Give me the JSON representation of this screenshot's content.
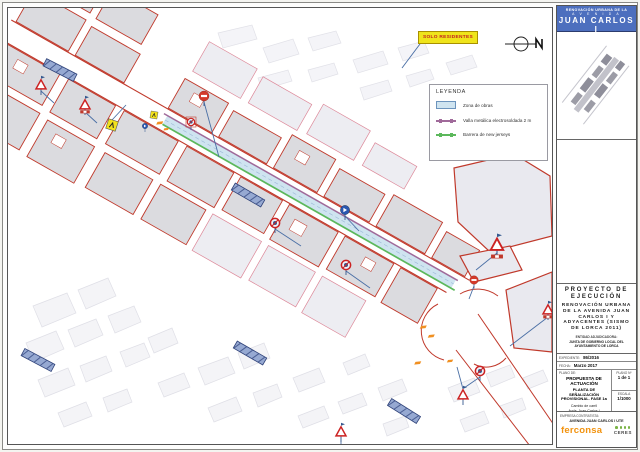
{
  "header": {
    "line1": "RENOVACIÓN URBANA DE LA",
    "line2": "A V E N I D A",
    "line3": "JUAN CARLOS I",
    "line4": "Y ADYACENTES (SISMO DE LORCA 2011)"
  },
  "map": {
    "solo_note": "SOLO RESIDENTES"
  },
  "legend": {
    "title": "LEYENDA",
    "items": [
      {
        "label": "Zona de obras",
        "type": "area",
        "color": "#cfe4f0"
      },
      {
        "label": "Valla metálica electrosoldada 2 m",
        "type": "line",
        "color": "#a06a9a"
      },
      {
        "label": "Barrera de new jerseys",
        "type": "line",
        "color": "#5cb85c"
      }
    ]
  },
  "titleblock": {
    "project_type": "PROYECTO DE EJECUCIÓN",
    "project_title": "RENOVACIÓN URBANA DE LA AVENIDA JUAN CARLOS I Y ADYACENTES (SISMO DE LORCA 2011)",
    "entity_label": "ENTIDAD ADJUDICADORA:",
    "entity_name": "JUNTA DE GOBIERNO LOCAL DEL AYUNTAMIENTO DE LORCA",
    "expediente_label": "EXPEDIENTE:",
    "expediente_value": "86/2016",
    "fecha_label": "FECHA:",
    "fecha_value": "Marzo 2017",
    "plano_de_label": "PLANO DE:",
    "plano_line1": "PROPUESTA DE ACTUACIÓN",
    "plano_line2": "PLANTA DE SEÑALIZACIÓN PROVISIONAL. FASE 1a",
    "plano_line3a": "Cambio de carril",
    "plano_line3b": "Avda. Juan Carlos I",
    "plano_num_label": "PLANO Nº",
    "plano_num_value": "1 de 1",
    "escala_label": "ESCALA",
    "escala_value": "1/1000",
    "empresa_label": "EMPRESA CONTRATISTA:",
    "empresa_name": "AVENIDA JUAN CARLOS I UTE",
    "logo_primary": "ferconsa",
    "logo_secondary": "CERES"
  },
  "colors": {
    "header_bg": "#4d6fbe",
    "building_outline": "#c0392b",
    "work_zone": "#cfe4f0",
    "fence": "#a06a9a",
    "barrier": "#5cb85c",
    "solo_bg": "#efe41b",
    "logo_orange": "#f2930f",
    "logo_green": "#79b344"
  }
}
